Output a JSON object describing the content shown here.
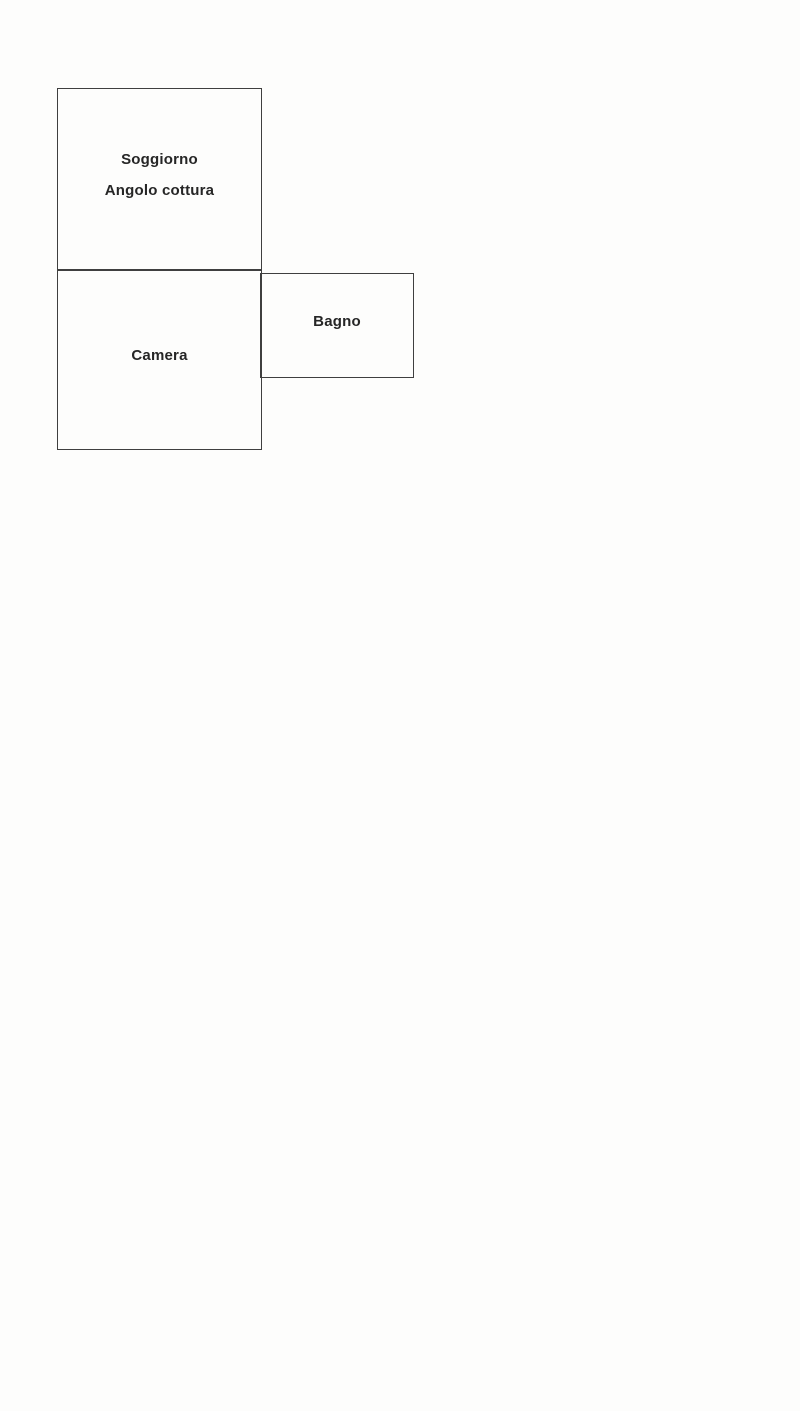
{
  "floorplan": {
    "rooms": [
      {
        "id": "soggiorno-angolo-cottura",
        "label_line1": "Soggiorno",
        "label_line2": "Angolo cottura"
      },
      {
        "id": "camera",
        "label": "Camera"
      },
      {
        "id": "bagno",
        "label": "Bagno"
      }
    ],
    "colors": {
      "wall": "#3f3f3f",
      "text": "#262626",
      "paper": "#fdfdfc"
    }
  }
}
